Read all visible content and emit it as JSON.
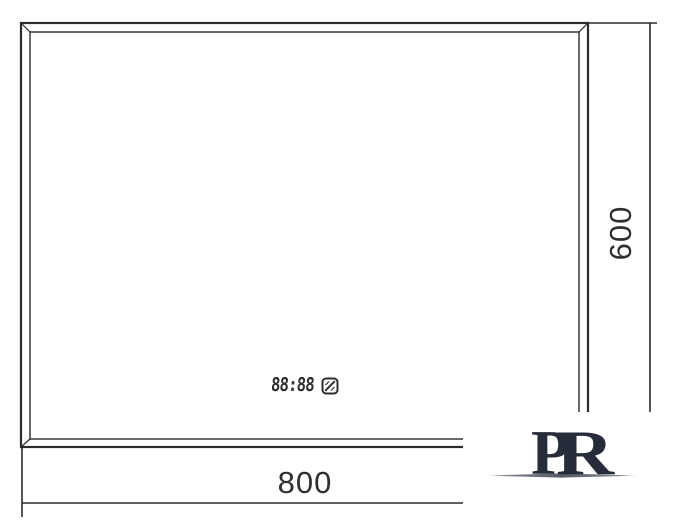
{
  "drawing": {
    "type": "mirror-dimension-diagram",
    "line_color": "#2b2b2b",
    "text_color": "#2f2f2f",
    "width_dimension": {
      "label": "800"
    },
    "height_dimension": {
      "label": "600"
    },
    "clock": {
      "display": "88:88",
      "icon": "defog-pad-icon"
    }
  },
  "logo": {
    "letter_p": "P",
    "letter_r": "R",
    "color": "#262c3a",
    "swoosh_color": "#6a707b"
  }
}
